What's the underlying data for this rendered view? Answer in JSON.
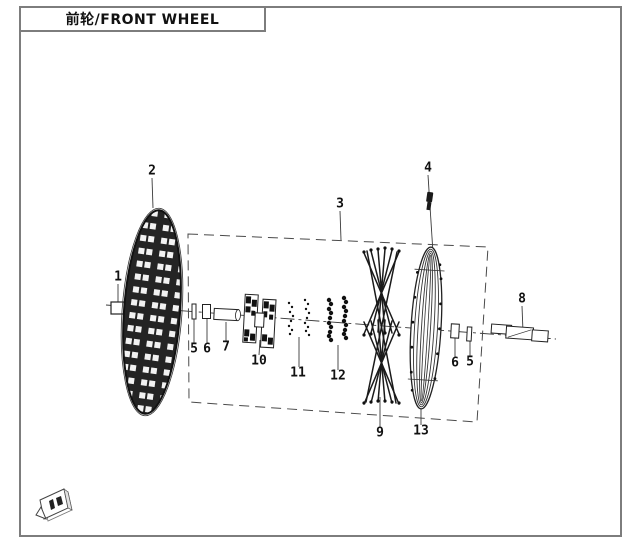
{
  "title": "前轮/FRONT WHEEL",
  "colors": {
    "line": "#1a1a1a",
    "leader": "#3a3a3a",
    "page_border": "#7d7d7d",
    "background": "#ffffff"
  },
  "diagram": {
    "type": "exploded-parts-drawing",
    "callouts": [
      {
        "n": "1",
        "x": 118,
        "y": 277
      },
      {
        "n": "2",
        "x": 152,
        "y": 171
      },
      {
        "n": "3",
        "x": 340,
        "y": 204
      },
      {
        "n": "4",
        "x": 428,
        "y": 168
      },
      {
        "n": "5",
        "x": 194,
        "y": 349
      },
      {
        "n": "6",
        "x": 207,
        "y": 349
      },
      {
        "n": "7",
        "x": 226,
        "y": 347
      },
      {
        "n": "10",
        "x": 259,
        "y": 361
      },
      {
        "n": "11",
        "x": 298,
        "y": 373
      },
      {
        "n": "12",
        "x": 338,
        "y": 376
      },
      {
        "n": "9",
        "x": 380,
        "y": 433
      },
      {
        "n": "13",
        "x": 421,
        "y": 431
      },
      {
        "n": "6",
        "x": 455,
        "y": 363
      },
      {
        "n": "5",
        "x": 470,
        "y": 362
      },
      {
        "n": "8",
        "x": 522,
        "y": 299
      }
    ]
  }
}
